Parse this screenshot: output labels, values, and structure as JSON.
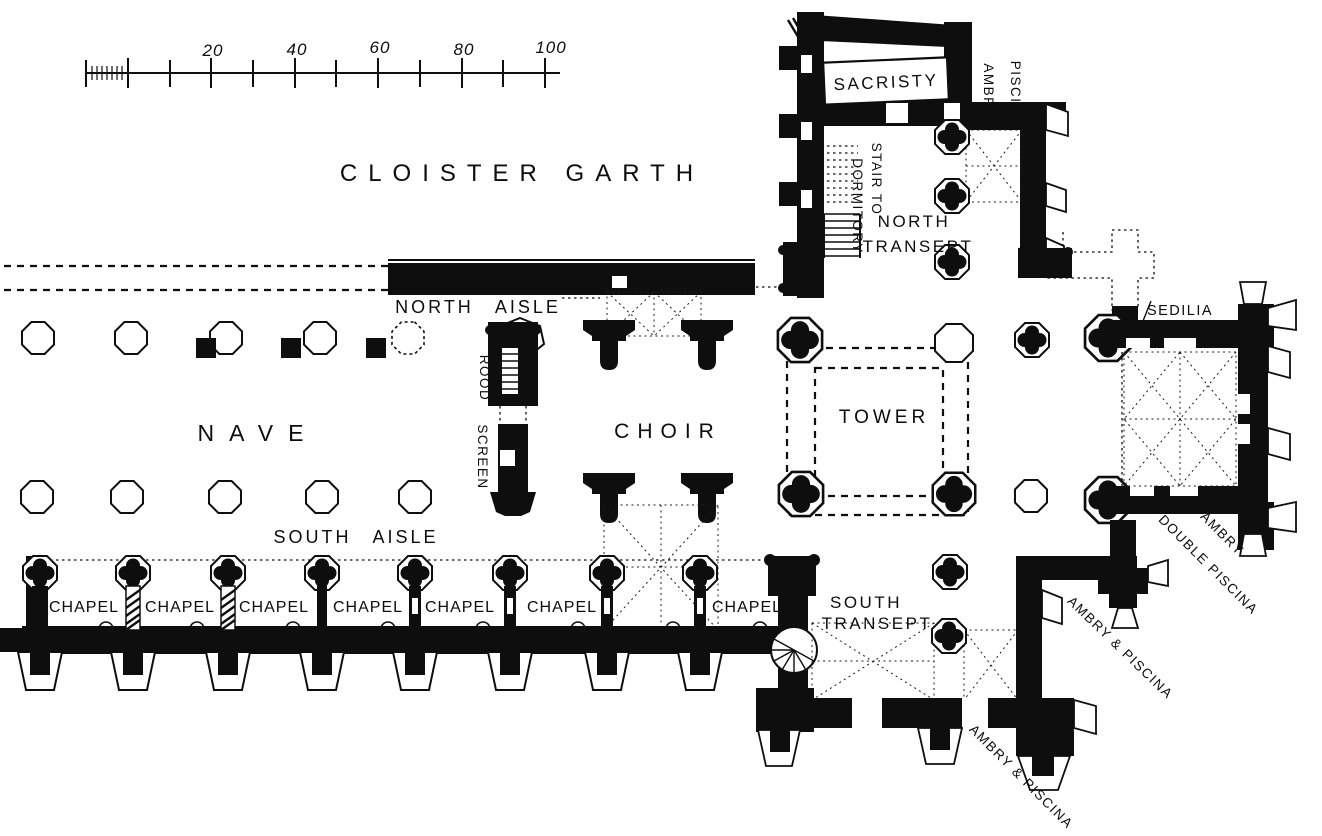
{
  "plan": {
    "type": "architectural floor plan of a priory church",
    "scale_ticks": [
      "20",
      "40",
      "60",
      "80",
      "100"
    ],
    "labels": {
      "cloister_garth": "CLOISTER GARTH",
      "nave": "NAVE",
      "north_aisle": "NORTH AISLE",
      "south_aisle": "SOUTH AISLE",
      "choir": "CHOIR",
      "tower": "TOWER",
      "rood": "ROOD",
      "screen": "SCREEN",
      "sacristy": "SACRISTY",
      "ambry_north": "AMBRY",
      "piscina_north": "PISCINA",
      "stair_to": "STAIR TO",
      "dormitory": "DORMITORY",
      "north_transept_line1": "NORTH",
      "north_transept_line2": "TRANSEPT",
      "south_transept_line1": "SOUTH",
      "south_transept_line2": "TRANSEPT",
      "sedilia": "SEDILIA",
      "ambry_presbytery": "AMBRY",
      "double_piscina": "DOUBLE PISCINA",
      "ambry_piscina_east": "AMBRY & PISCINA",
      "ambry_piscina_south": "AMBRY & PISCINA",
      "chapel": [
        "CHAPEL",
        "CHAPEL",
        "CHAPEL",
        "CHAPEL",
        "CHAPEL",
        "CHAPEL",
        "CHAPEL"
      ]
    },
    "colors": {
      "ink": "#0e0e0e",
      "paper": "#ffffff"
    }
  }
}
